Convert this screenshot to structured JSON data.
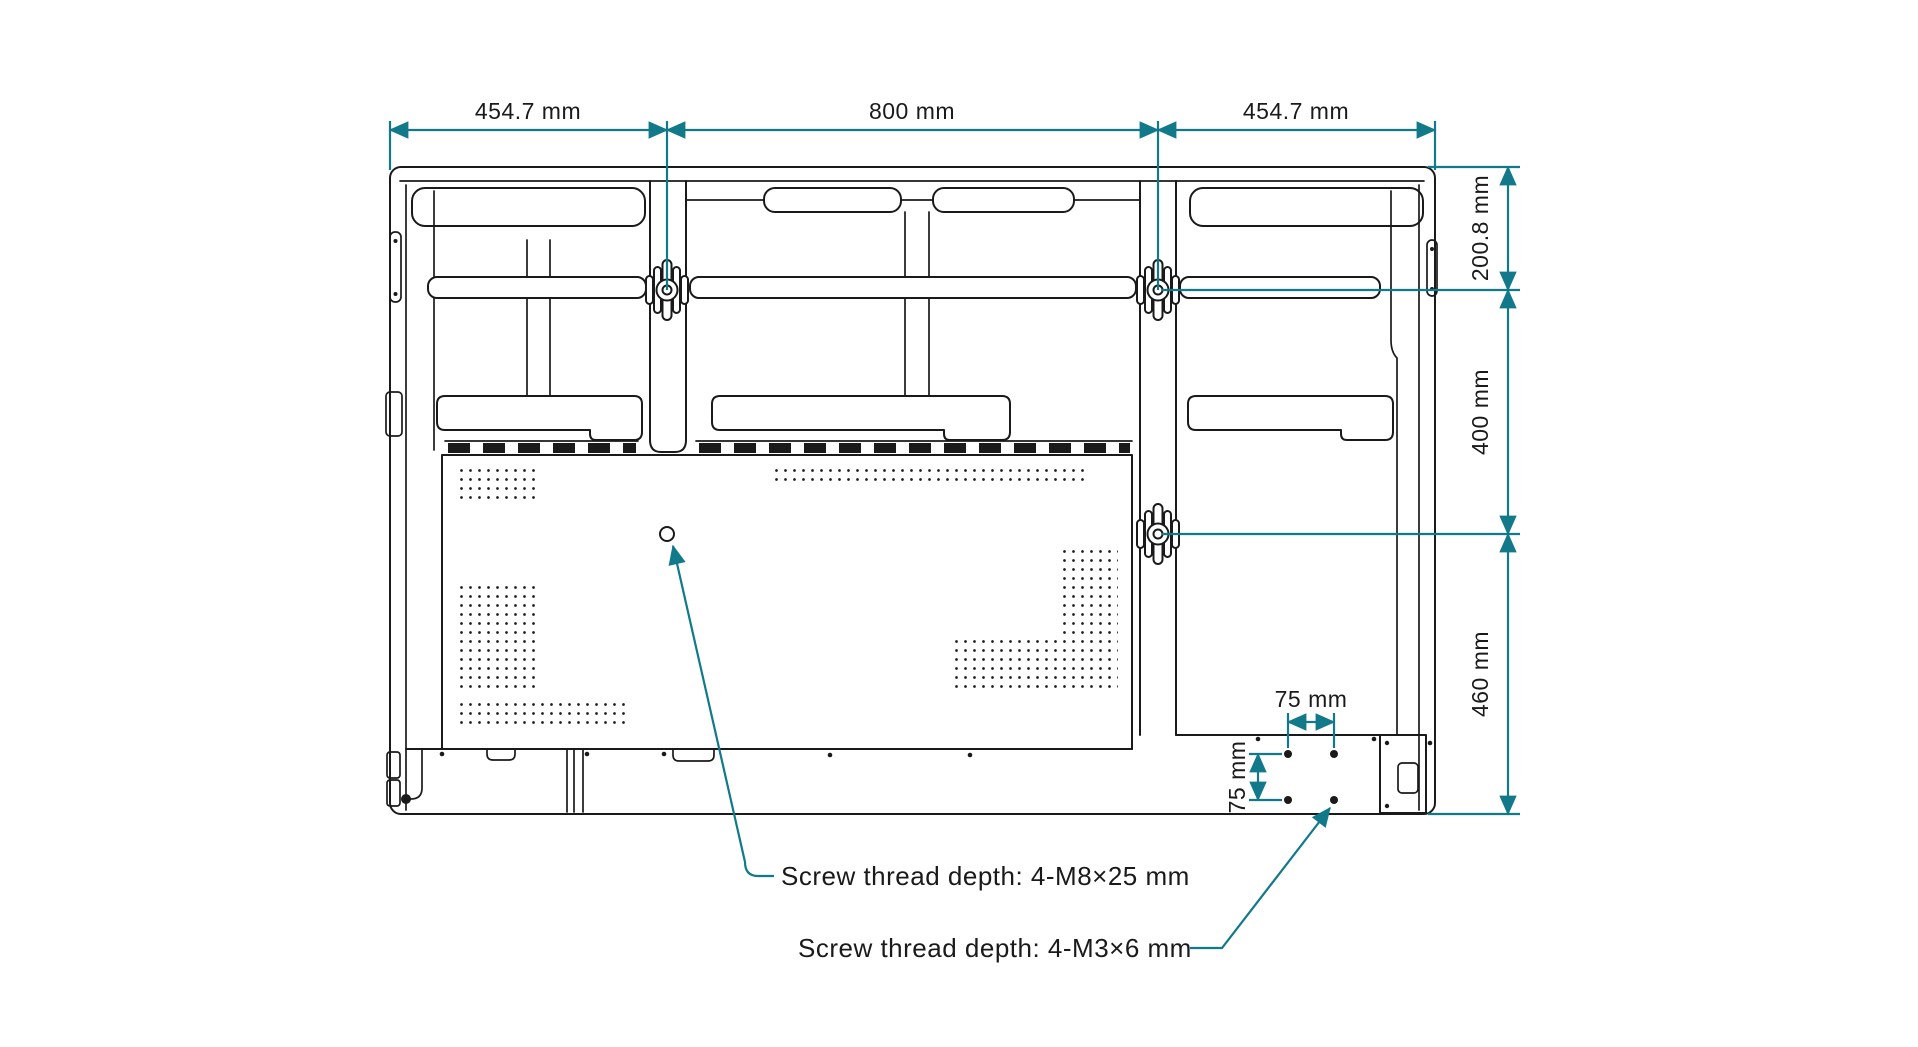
{
  "colors": {
    "dimension_accent": "#117989",
    "line_color": "#1A1A1A",
    "background": "#FFFFFF"
  },
  "dimensions": {
    "top": [
      "454.7 mm",
      "800 mm",
      "454.7 mm"
    ],
    "right": [
      "200.8 mm",
      "400 mm",
      "460 mm"
    ],
    "screw_pattern": {
      "horizontal": "75 mm",
      "vertical": "75 mm"
    }
  },
  "annotations": {
    "vesa_screw_note": "Screw thread depth: 4-M8×25 mm",
    "bracket_screw_note": "Screw thread depth: 4-M3×6 mm"
  }
}
